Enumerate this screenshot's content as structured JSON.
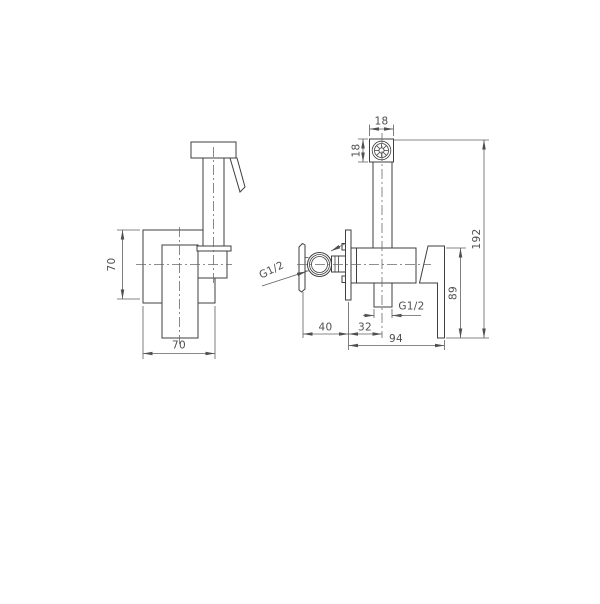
{
  "page": {
    "background": "#ffffff",
    "line_color": "#3f3f3f",
    "dimension_color": "#4f4f4f"
  },
  "front_view": {
    "dim_plate_height": "70",
    "dim_plate_width": "70"
  },
  "side_view": {
    "dim_nozzle_width": "18",
    "dim_nozzle_height": "18",
    "dim_overall_height": "192",
    "dim_handle_drop": "89",
    "dim_valve_offset": "40",
    "dim_outlet_offset": "32",
    "dim_overall_depth": "94",
    "inlet_thread_label": "G1/2",
    "outlet_thread_label": "G1/2"
  }
}
